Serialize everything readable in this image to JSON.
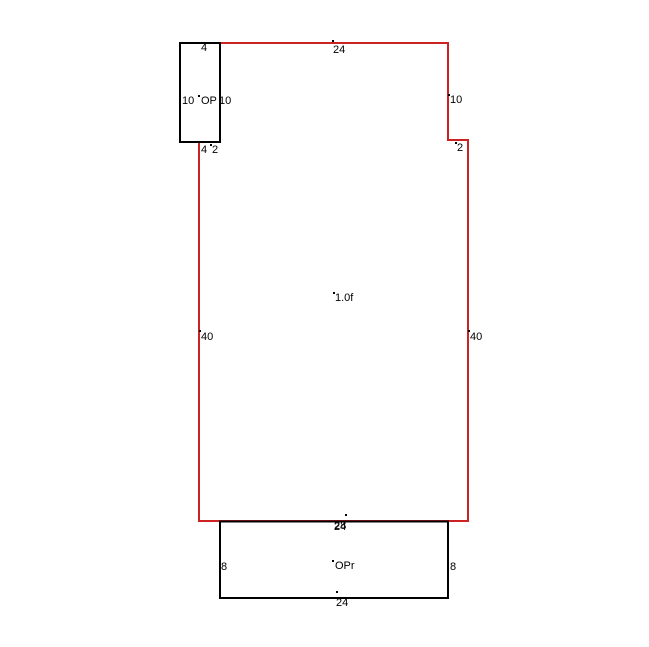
{
  "sketch": {
    "colors": {
      "main_outline": "#cc2222",
      "porch_outline": "#000000",
      "background": "#ffffff",
      "label_text": "#000000"
    },
    "main_area": {
      "label": "1.0f",
      "dimensions": {
        "top": "24",
        "right_upper": "10",
        "right_notch": "2",
        "right_lower": "40",
        "left": "40",
        "bottom": "28"
      }
    },
    "open_porch": {
      "label": "OP",
      "dimensions": {
        "top": "4",
        "left": "10",
        "right": "10",
        "bottom": "4",
        "bottom_offset": "2"
      }
    },
    "rear_porch": {
      "label": "OPr",
      "dimensions": {
        "top": "24",
        "left": "8",
        "right": "8",
        "bottom": "24"
      }
    }
  }
}
